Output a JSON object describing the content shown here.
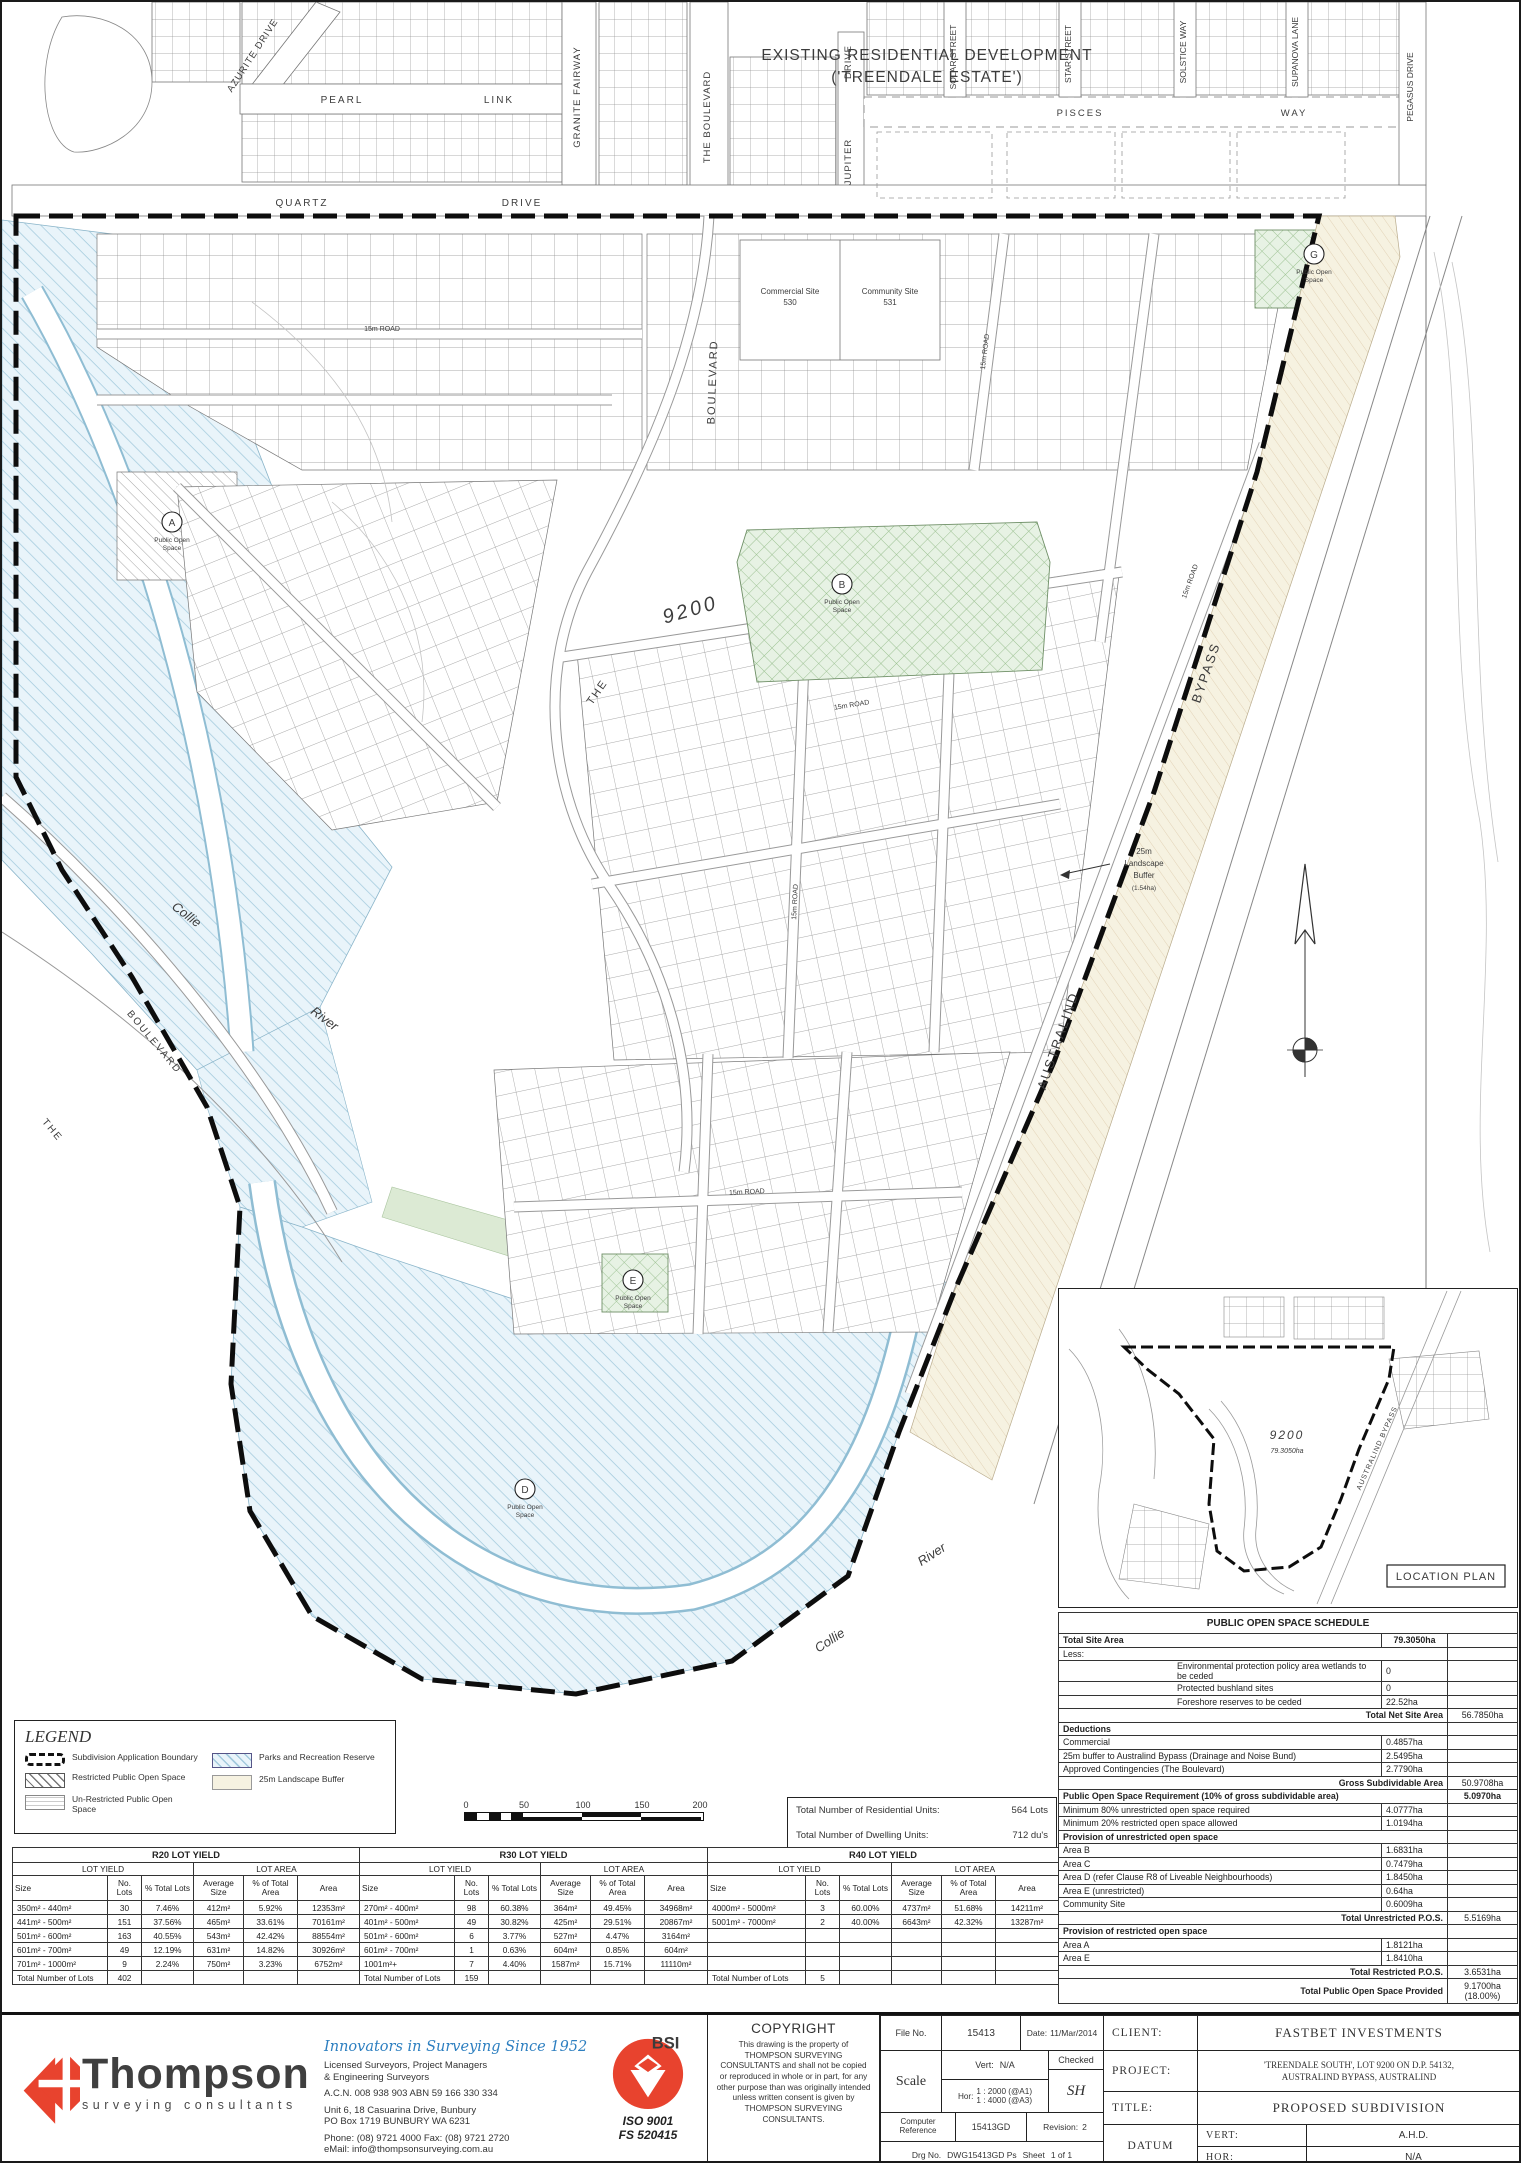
{
  "map": {
    "dev_title1": "EXISTING RESIDENTIAL DEVELOPMENT",
    "dev_title2": "('TREENDALE ESTATE')",
    "streets": {
      "azurite": "AZURITE  DRIVE",
      "granite": "GRANITE  FAIRWAY",
      "pearl": "PEARL",
      "link": "LINK",
      "quartz": "QUARTZ",
      "quartz_drive": "DRIVE",
      "the_boulevard_top": "THE  BOULEVARD",
      "jupiter": "JUPITER",
      "jupiter_drive": "DRIVE",
      "solar": "SOLAR STREET",
      "star": "STAR STREET",
      "solstice": "SOLSTICE WAY",
      "supanova": "SUPANOVA LANE",
      "pegasus": "PEGASUS  DRIVE",
      "pisces": "PISCES",
      "pisces_way": "WAY"
    },
    "labels": {
      "lot": "9200",
      "the": "THE",
      "boulevard": "BOULEVARD",
      "collie": "Collie",
      "river": "River",
      "australind": "AUSTRALIND",
      "bypass": "BYPASS",
      "road_15m": "15m ROAD",
      "commercial_site": "Commercial Site",
      "commercial_num": "530",
      "community_site": "Community Site",
      "community_num": "531",
      "buffer_1": "25m",
      "buffer_2": "Landscape",
      "buffer_3": "Buffer",
      "buffer_4": "(1.54ha)",
      "pos_line1": "Public Open",
      "pos_line2": "Space"
    },
    "markers": {
      "a": "A",
      "b": "B",
      "d": "D",
      "e": "E",
      "g": "G"
    }
  },
  "location_plan": {
    "title": "LOCATION PLAN",
    "lot": "9200",
    "area": "79.3050ha",
    "bypass": "AUSTRALIND BYPASS"
  },
  "scalebar": {
    "ticks": [
      "0",
      "50",
      "100",
      "150",
      "200"
    ]
  },
  "units_box": {
    "rows": [
      [
        "Total Number of Residential Units:",
        "564 Lots"
      ],
      [
        "Total Number of Dwelling Units:",
        "712 du's"
      ]
    ]
  },
  "legend": {
    "title": "LEGEND",
    "items": [
      {
        "label": "Subdivision Application Boundary"
      },
      {
        "label": "Restricted Public Open Space"
      },
      {
        "label": "Un-Restricted Public Open Space"
      },
      {
        "label": "Parks and Recreation Reserve"
      },
      {
        "label": "25m Landscape Buffer"
      }
    ]
  },
  "tables": {
    "r20": {
      "title": "R20 LOT YIELD",
      "g1": "LOT YIELD",
      "g2": "LOT AREA",
      "cols": [
        "Size",
        "No. Lots",
        "% Total Lots",
        "Average Size",
        "% of Total Area",
        "Area"
      ],
      "rows": [
        [
          "350m² - 440m²",
          "30",
          "7.46%",
          "412m²",
          "5.92%",
          "12353m²"
        ],
        [
          "441m² - 500m²",
          "151",
          "37.56%",
          "465m²",
          "33.61%",
          "70161m²"
        ],
        [
          "501m² - 600m²",
          "163",
          "40.55%",
          "543m²",
          "42.42%",
          "88554m²"
        ],
        [
          "601m² - 700m²",
          "49",
          "12.19%",
          "631m²",
          "14.82%",
          "30926m²"
        ],
        [
          "701m² - 1000m²",
          "9",
          "2.24%",
          "750m²",
          "3.23%",
          "6752m²"
        ]
      ],
      "total_label": "Total Number of Lots",
      "total": "402"
    },
    "r30": {
      "title": "R30 LOT YIELD",
      "g1": "LOT YIELD",
      "g2": "LOT AREA",
      "cols": [
        "Size",
        "No. Lots",
        "% Total Lots",
        "Average Size",
        "% of Total Area",
        "Area"
      ],
      "rows": [
        [
          "270m² - 400m²",
          "98",
          "60.38%",
          "364m²",
          "49.45%",
          "34968m²"
        ],
        [
          "401m² - 500m²",
          "49",
          "30.82%",
          "425m²",
          "29.51%",
          "20867m²"
        ],
        [
          "501m² - 600m²",
          "6",
          "3.77%",
          "527m²",
          "4.47%",
          "3164m²"
        ],
        [
          "601m² - 700m²",
          "1",
          "0.63%",
          "604m²",
          "0.85%",
          "604m²"
        ],
        [
          "1001m²+",
          "7",
          "4.40%",
          "1587m²",
          "15.71%",
          "11110m²"
        ]
      ],
      "total_label": "Total Number of Lots",
      "total": "159"
    },
    "r40": {
      "title": "R40 LOT YIELD",
      "g1": "LOT YIELD",
      "g2": "LOT AREA",
      "cols": [
        "Size",
        "No. Lots",
        "% Total Lots",
        "Average Size",
        "% of Total Area",
        "Area"
      ],
      "rows": [
        [
          "4000m² - 5000m²",
          "3",
          "60.00%",
          "4737m²",
          "51.68%",
          "14211m²"
        ],
        [
          "5001m² - 7000m²",
          "2",
          "40.00%",
          "6643m²",
          "42.32%",
          "13287m²"
        ],
        [
          "",
          "",
          "",
          "",
          "",
          ""
        ],
        [
          "",
          "",
          "",
          "",
          "",
          ""
        ],
        [
          "",
          "",
          "",
          "",
          "",
          ""
        ]
      ],
      "total_label": "Total Number of Lots",
      "total": "5"
    }
  },
  "pos_schedule": {
    "title": "PUBLIC OPEN SPACE SCHEDULE",
    "total_site_label": "Total Site Area",
    "total_site_value": "79.3050ha",
    "less_label": "Less:",
    "less_items": [
      [
        "Environmental protection policy area wetlands to be ceded",
        "0",
        ""
      ],
      [
        "Protected bushland sites",
        "0",
        ""
      ],
      [
        "Foreshore reserves to be ceded",
        "22.52ha",
        ""
      ]
    ],
    "net_label": "Total Net Site Area",
    "net_value": "56.7850ha",
    "deductions_label": "Deductions",
    "deduction_items": [
      [
        "Commercial",
        "0.4857ha",
        ""
      ],
      [
        "25m buffer to Australind Bypass (Drainage and Noise Bund)",
        "2.5495ha",
        ""
      ],
      [
        "Approved Contingencies (The Boulevard)",
        "2.7790ha",
        ""
      ]
    ],
    "gross_label": "Gross Subdividable Area",
    "gross_value": "50.9708ha",
    "req_label": "Public Open Space Requirement (10% of gross subdividable area)",
    "req_value": "5.0970ha",
    "req_items": [
      [
        "Minimum 80% unrestricted open space required",
        "4.0777ha",
        ""
      ],
      [
        "Minimum 20% restricted open space allowed",
        "1.0194ha",
        ""
      ]
    ],
    "unres_label": "Provision of unrestricted open space",
    "unres_items": [
      [
        "Area B",
        "1.6831ha",
        ""
      ],
      [
        "Area C",
        "0.7479ha",
        ""
      ],
      [
        "Area D (refer Clause R8 of Liveable Neighbourhoods)",
        "1.8450ha",
        ""
      ],
      [
        "Area E (unrestricted)",
        "0.64ha",
        ""
      ],
      [
        "Community Site",
        "0.6009ha",
        ""
      ]
    ],
    "total_unres_label": "Total Unrestricted P.O.S.",
    "total_unres_value": "5.5169ha",
    "res_label": "Provision of restricted open space",
    "res_items": [
      [
        "Area A",
        "1.8121ha",
        ""
      ],
      [
        "Area E",
        "1.8410ha",
        ""
      ]
    ],
    "total_res_label": "Total Restricted P.O.S.",
    "total_res_value": "3.6531ha",
    "provided_label": "Total Public Open Space Provided",
    "provided_value": "9.1700ha (18.00%)"
  },
  "titleblock": {
    "thompson": {
      "name": "Thompson",
      "sub": "surveying consultants",
      "tagline": "Innovators in Surveying Since 1952",
      "line1": "Licensed Surveyors, Project Managers",
      "line2": "& Engineering Surveyors",
      "acn": "A.C.N. 008 938 903  ABN 59 166 330 334",
      "addr1": "Unit 6, 18 Casuarina Drive, Bunbury",
      "addr2": "PO Box 1719  BUNBURY WA 6231",
      "phone": "Phone: (08) 9721 4000 Fax: (08) 9721 2720",
      "email": "eMail: info@thompsonsurveying.com.au"
    },
    "bsi": {
      "name": "BSI",
      "iso": "ISO 9001",
      "fs": "FS 520415"
    },
    "copyright": {
      "title": "COPYRIGHT",
      "body": "This drawing is the property of THOMPSON SURVEYING CONSULTANTS and shall not be copied or reproduced in whole or in part, for any other purpose than was originally intended unless written consent is given by THOMPSON SURVEYING CONSULTANTS."
    },
    "fileno_label": "File No.",
    "fileno": "15413",
    "date_label": "Date:",
    "date": "11/Mar/2014",
    "scale_label": "Scale",
    "vert_label": "Vert:",
    "vert": "N/A",
    "hor_label": "Hor:",
    "hor1": "1 : 2000 (@A1)",
    "hor2": "1 : 4000 (@A3)",
    "checked_label": "Checked",
    "checked": "SH",
    "compref_label": "Computer Reference",
    "compref": "15413GD",
    "rev_label": "Revision:",
    "rev": "2",
    "drg_label": "Drg No.",
    "drg": "DWG15413GD Ps",
    "sheet_label": "Sheet",
    "sheet": "1 of 1",
    "client_label": "CLIENT:",
    "client": "FASTBET INVESTMENTS",
    "project_label": "PROJECT:",
    "project1": "'TREENDALE SOUTH', LOT 9200 ON D.P. 54132,",
    "project2": "AUSTRALIND BYPASS, AUSTRALIND",
    "title_label": "TITLE:",
    "title": "PROPOSED SUBDIVISION",
    "datum_label": "DATUM",
    "datum_vert_label": "VERT:",
    "datum_vert": "A.H.D.",
    "datum_hor_label": "HOR:",
    "datum_hor": "N/A"
  },
  "colors": {
    "brand_red": "#e8432e",
    "tagline_blue": "#2d7fc0",
    "water_fill": "#e9f4fa",
    "water_line": "#a3cadd",
    "pos_green": "#e7f2e4",
    "buffer_cream": "#f6f2e1",
    "boundary_ink": "#0d0d0d"
  }
}
